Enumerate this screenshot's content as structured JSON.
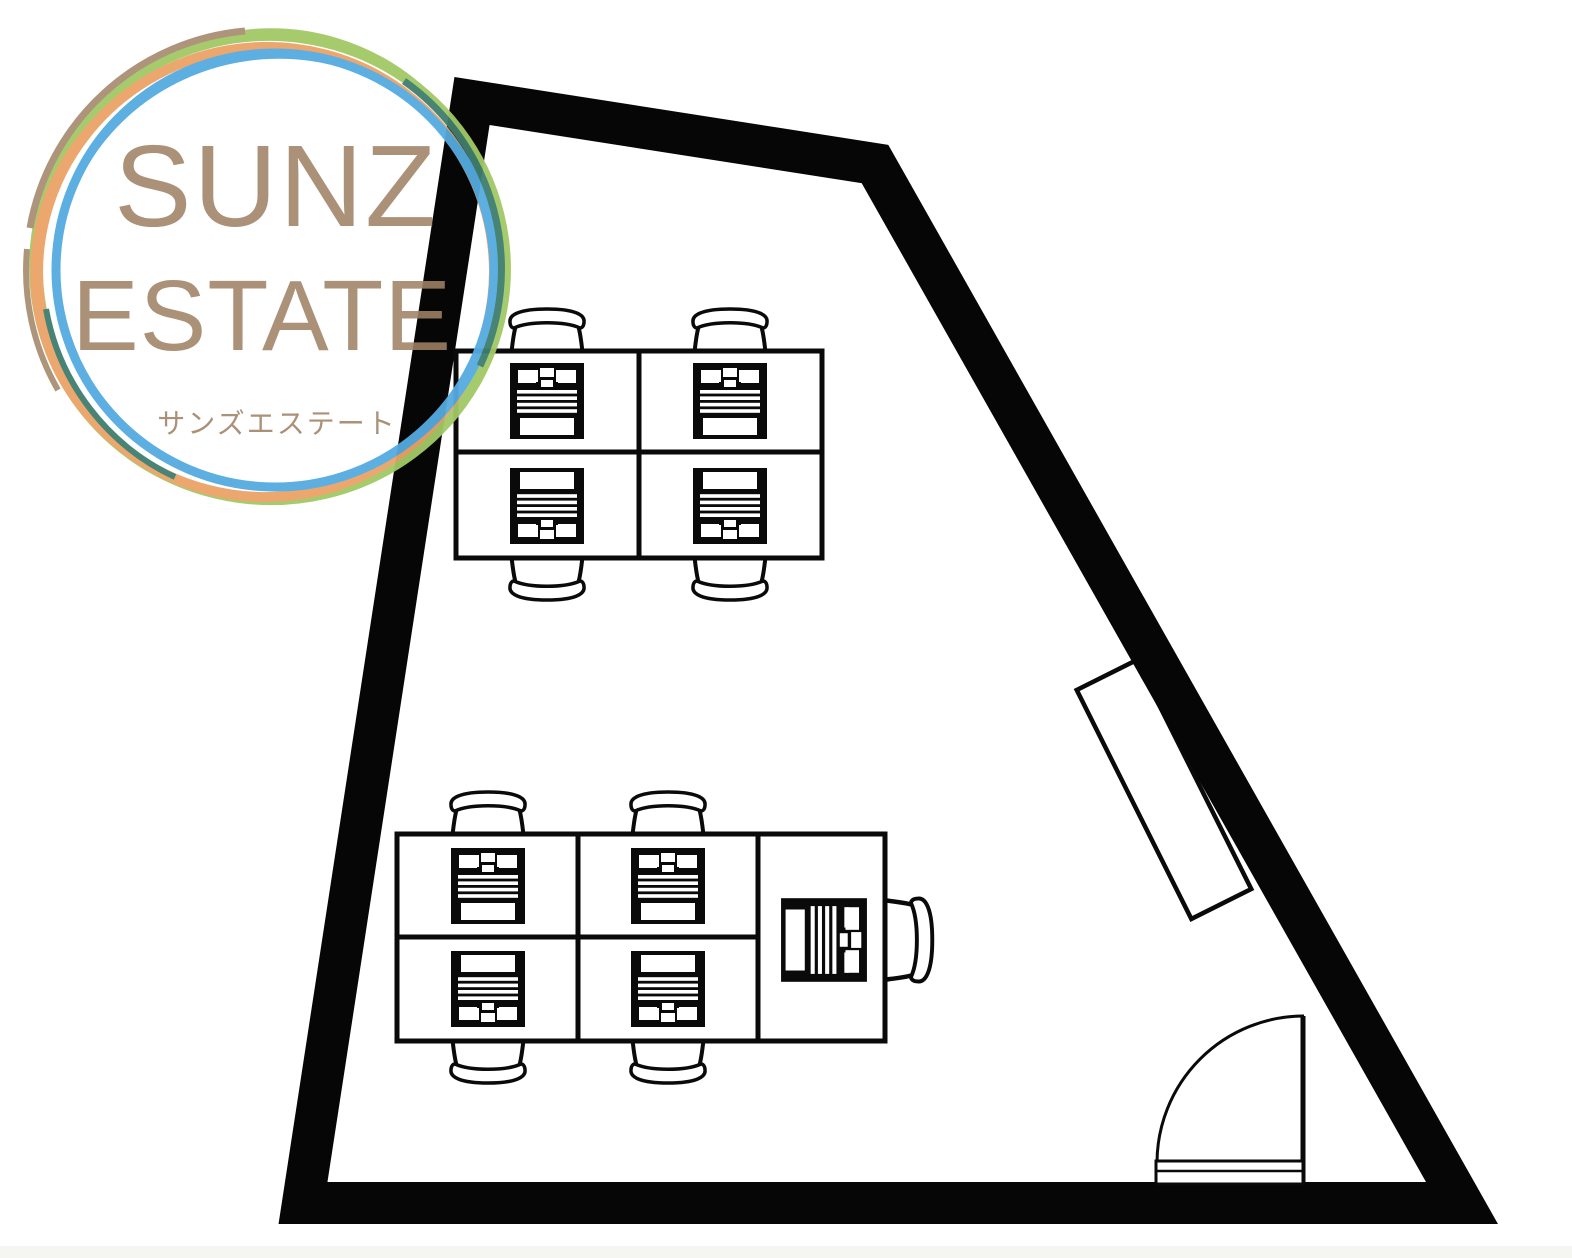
{
  "page": {
    "background": "#ffffff",
    "footer_strip_color": "#f5f5f2"
  },
  "logo": {
    "line1": "SUNZ",
    "line2": "ESTATE",
    "subtitle": "サンズエステート",
    "text_color": "#a08265",
    "rings": {
      "green": "#a2c966",
      "orange": "#eca368",
      "blue": "#55abe0",
      "teal": "#3f7e6e",
      "tan": "#a98f74"
    }
  },
  "floor_plan": {
    "wall_color": "#060606",
    "line_color": "#0a0a0a",
    "furniture": {
      "upper_cluster": {
        "type": "desk-island",
        "desks": 4,
        "chairs": 4,
        "workstations": 4
      },
      "lower_cluster": {
        "type": "desk-island",
        "desks": 4,
        "chairs": 4,
        "workstations": 4
      },
      "side_desk": {
        "type": "single-desk",
        "desks": 1,
        "chairs": 1,
        "workstations": 1
      },
      "door": {
        "type": "hinged-swing-door",
        "position": "bottom-right"
      },
      "shelf": {
        "type": "cabinet",
        "position": "right-wall"
      }
    }
  }
}
